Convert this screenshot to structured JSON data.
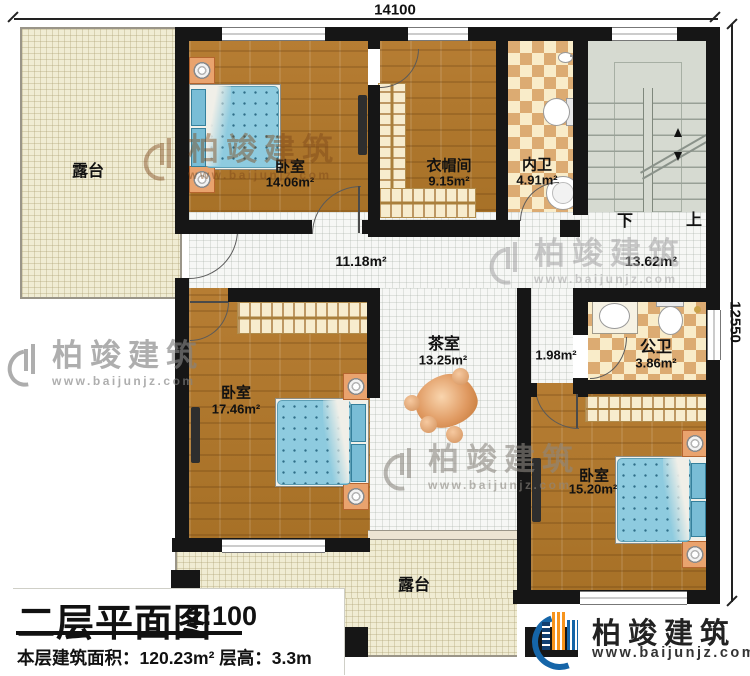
{
  "plan": {
    "dimensions": {
      "width_top": "14100",
      "height_right": "12550"
    },
    "rooms": {
      "terrace_top": {
        "name": "露台"
      },
      "bedroom_top": {
        "name": "卧室",
        "area": "14.06m²"
      },
      "cloakroom": {
        "name": "衣帽间",
        "area": "9.15m²"
      },
      "inner_bath": {
        "name": "内卫",
        "area": "4.91m²"
      },
      "hallway": {
        "area": "11.18m²"
      },
      "stair_hall": {
        "area": "13.62m²"
      },
      "bedroom_left": {
        "name": "卧室",
        "area": "17.46m²"
      },
      "tea_room": {
        "name": "茶室",
        "area": "13.25m²"
      },
      "corridor": {
        "area": "1.98m²"
      },
      "public_bath": {
        "name": "公卫",
        "area": "3.86m²"
      },
      "bedroom_right": {
        "name": "卧室",
        "area": "15.20m²"
      },
      "terrace_bottom": {
        "name": "露台"
      }
    },
    "stairs": {
      "down_label": "下",
      "up_label": "上"
    }
  },
  "title_block": {
    "title": "二层平面图",
    "scale": "1:100",
    "info": "本层建筑面积：120.23m²  层高：3.3m"
  },
  "brand": {
    "name": "柏竣建筑",
    "url": "www.baijunjz.com"
  },
  "watermark": {
    "name": "柏竣建筑",
    "url": "www.baijunjz.com"
  },
  "colors": {
    "wall": "#161616",
    "wood": "#b0782f",
    "tile_accent": "#dcab72",
    "terrace": "#f0ecd3",
    "stairs": "#d6dad1",
    "bed": "#8ecbdf",
    "brand_blue": "#1565a8",
    "brand_orange": "#f7941d"
  }
}
